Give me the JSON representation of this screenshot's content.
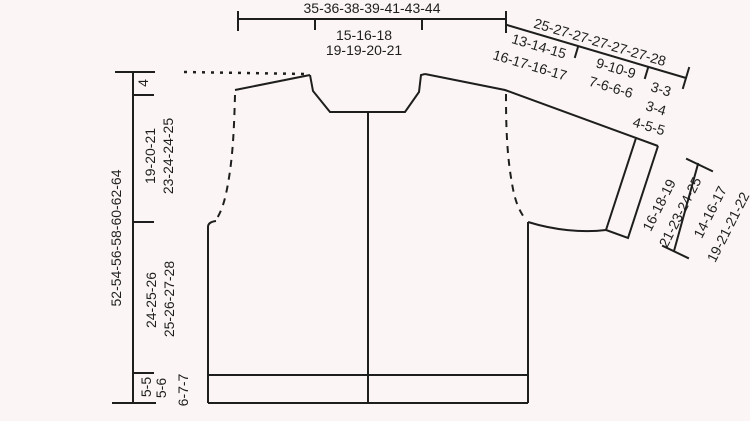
{
  "colors": {
    "background": "#fbf6f5",
    "line": "#1e1e1e",
    "text": "#1e1e1e"
  },
  "diagram": {
    "kind": "knitting-pattern-garment-schematic",
    "labels": {
      "top_width": "35-36-38-39-41-43-44",
      "neck_width": {
        "line1": "15-16-18",
        "line2": "19-19-20-21"
      },
      "sleeve_total": "25-27-27-27-27-27-28",
      "sleeve_upper": {
        "line1": "13-14-15",
        "line2": "16-17-16-17"
      },
      "sleeve_mid": {
        "line1": "9-10-9",
        "line2": "7-6-6-6"
      },
      "sleeve_end": {
        "line1": "3-3",
        "line2": "3-4",
        "line3": "4-5-5"
      },
      "total_length": "52-54-56-58-60-62-64",
      "shoulder_drop": "4",
      "armhole_depth": {
        "line1": "19-20-21",
        "line2": "23-24-24-25"
      },
      "body_length": {
        "line1": "24-25-26",
        "line2": "25-26-27-28"
      },
      "bottom_rib": {
        "line1": "5-5",
        "line2": "5-6",
        "line3": "6-7-7"
      },
      "cuff_width": {
        "line1": "16-18-19",
        "line2": "21-23-24-25"
      },
      "cuff_edge": {
        "line1": "14-16-17",
        "line2": "19-21-21-22"
      }
    }
  }
}
